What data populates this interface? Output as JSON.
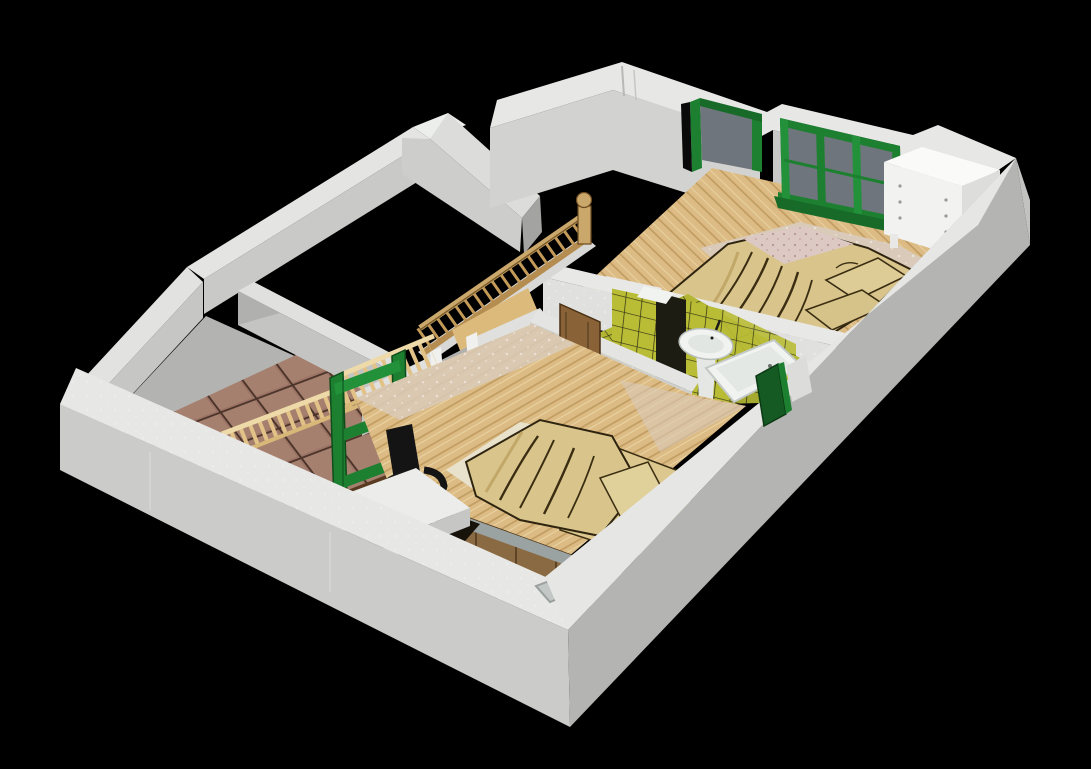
{
  "scene": {
    "type": "3d-floorplan-render",
    "style": "isometric dollhouse cutaway of an upper residential floor on black background",
    "background": "#000000"
  },
  "palette": {
    "background": "#000000",
    "wall_top": "#e7e7e5",
    "wall_face_sw": "#cbcbc9",
    "wall_face_se": "#b4b4b2",
    "wall_face_inner_light": "#d2d2d0",
    "wall_face_inner_mid": "#c6c6c4",
    "wall_face_shadow": "#a3a3a1",
    "wood_floor": "#dcbc84",
    "wood_floor_line": "#c09b60",
    "speckle_band": "#d9cab9",
    "tile_brown": "#9b7365",
    "tile_brown_grout": "#4a3328",
    "bath_tile": "#b9bc35",
    "bath_tile_grout": "#2f2f12",
    "door_green": "#1d8030",
    "door_green_dark": "#145a22",
    "glass_gray": "#6f757d",
    "duvet_tan": "#d9c58c",
    "duvet_fold_line": "#3a2d12",
    "pillow_tan": "#ddcc96",
    "sheet_pink_speckled": "#dcc9c4",
    "banister_wood": "#c49a58",
    "stair_wood": "#dcba7c",
    "cabinet_wood": "#8a6a42",
    "chair_black": "#141414",
    "porcelain_white": "#f1f3f1",
    "dresser_white": "#f2f2f0",
    "terracotta_floor_border": "#b3b3b1"
  },
  "rooms": [
    {
      "id": "master-bedroom",
      "label": "master bedroom (top right)",
      "floor": "wood planks",
      "contents": [
        "double bed with crumpled tan duvet",
        "tan pillows",
        "pink speckled sheet",
        "white chest of drawers",
        "green french doors with gray glass",
        "green framed doorway"
      ]
    },
    {
      "id": "second-bedroom",
      "label": "second bedroom (bottom center)",
      "floor": "wood planks",
      "contents": [
        "bed with crumpled tan duvet",
        "wooden headboard cabinet",
        "black office chair",
        "white desk",
        "green door frame"
      ]
    },
    {
      "id": "bathroom",
      "label": "bathroom (center)",
      "floor": "yellow tile",
      "contents": [
        "yellow tiled shower walls",
        "white pedestal sink",
        "white bathtub",
        "dark green door",
        "white shelf"
      ]
    },
    {
      "id": "landing-hall",
      "label": "tiled landing (left)",
      "floor": "terracotta tile",
      "contents": [
        "light wood balustrade",
        "tall green door frame"
      ]
    },
    {
      "id": "stairwell",
      "label": "stairwell (center left)",
      "contents": [
        "wood banister with turned spindles",
        "newel post with ball top",
        "descending wooden staircase",
        "brown wooden door"
      ]
    },
    {
      "id": "void-room-northwest",
      "label": "unrendered room (top left)",
      "floor": "black void"
    },
    {
      "id": "void-room-north",
      "label": "unrendered room (top center)",
      "floor": "black void"
    }
  ]
}
